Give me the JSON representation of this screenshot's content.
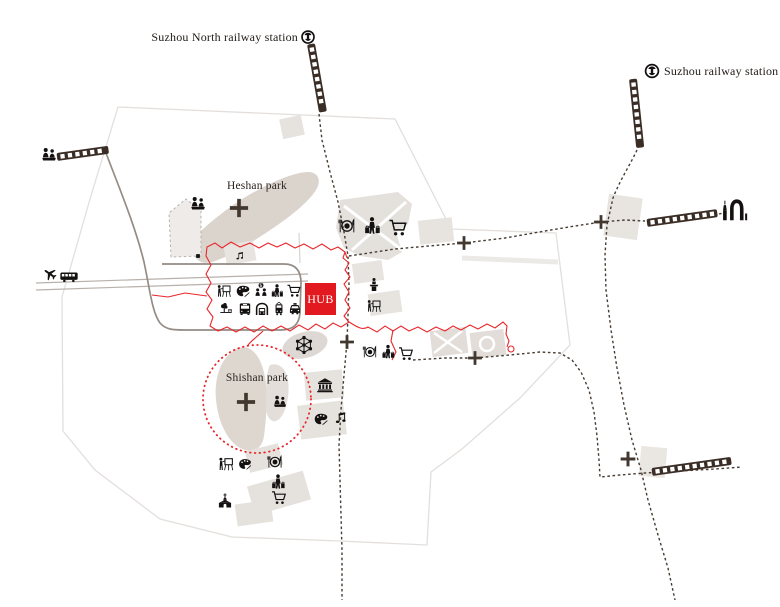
{
  "labels": {
    "station_north": "Suzhou North railway station",
    "station_main": "Suzhou railway station",
    "park_heshan": "Heshan park",
    "park_shishan": "Shishan park",
    "hub": "HUB"
  },
  "colors": {
    "accent_red": "#e2191f",
    "icon_black": "#141110",
    "dashed_line": "#463c33",
    "track_brown": "#3a2d25",
    "blob_light": "#e5e1dd"
  },
  "map": {
    "icons": [
      {
        "n": "people",
        "x": 49,
        "y": 155,
        "s": 18
      },
      {
        "n": "plane",
        "x": 50,
        "y": 274,
        "s": 15,
        "r": -55
      },
      {
        "n": "traincar",
        "x": 69,
        "y": 277,
        "s": 20
      },
      {
        "n": "people",
        "x": 198,
        "y": 204,
        "s": 18
      },
      {
        "n": "music",
        "x": 240,
        "y": 256,
        "s": 11
      },
      {
        "n": "marker-square",
        "x": 198,
        "y": 256,
        "s": 5
      },
      {
        "n": "dining",
        "x": 347,
        "y": 226,
        "s": 19
      },
      {
        "n": "shopper",
        "x": 372,
        "y": 226,
        "s": 21
      },
      {
        "n": "cart",
        "x": 398,
        "y": 228,
        "s": 21
      },
      {
        "n": "painter",
        "x": 224,
        "y": 291,
        "s": 16
      },
      {
        "n": "palette",
        "x": 243,
        "y": 291,
        "s": 16
      },
      {
        "n": "meeting",
        "x": 261,
        "y": 290,
        "s": 16
      },
      {
        "n": "shopper",
        "x": 277,
        "y": 291,
        "s": 16
      },
      {
        "n": "cart",
        "x": 294,
        "y": 291,
        "s": 16
      },
      {
        "n": "park",
        "x": 226,
        "y": 309,
        "s": 16
      },
      {
        "n": "bus",
        "x": 245,
        "y": 309,
        "s": 16
      },
      {
        "n": "metro",
        "x": 262,
        "y": 309,
        "s": 16
      },
      {
        "n": "tram",
        "x": 279,
        "y": 309,
        "s": 16
      },
      {
        "n": "taxi",
        "x": 295,
        "y": 309,
        "s": 16
      },
      {
        "n": "speaker",
        "x": 374,
        "y": 285,
        "s": 16
      },
      {
        "n": "painter",
        "x": 374,
        "y": 306,
        "s": 16
      },
      {
        "n": "network",
        "x": 304,
        "y": 345,
        "s": 24
      },
      {
        "n": "dining",
        "x": 370,
        "y": 352,
        "s": 16
      },
      {
        "n": "shopper",
        "x": 388,
        "y": 352,
        "s": 17
      },
      {
        "n": "cart",
        "x": 406,
        "y": 354,
        "s": 17
      },
      {
        "n": "museum",
        "x": 325,
        "y": 385,
        "s": 19
      },
      {
        "n": "people",
        "x": 280,
        "y": 402,
        "s": 16
      },
      {
        "n": "palette",
        "x": 321,
        "y": 419,
        "s": 16
      },
      {
        "n": "music",
        "x": 341,
        "y": 418,
        "s": 16
      },
      {
        "n": "painter",
        "x": 226,
        "y": 464,
        "s": 17
      },
      {
        "n": "palette",
        "x": 245,
        "y": 464,
        "s": 15
      },
      {
        "n": "dining",
        "x": 275,
        "y": 462,
        "s": 17
      },
      {
        "n": "shopper",
        "x": 278,
        "y": 482,
        "s": 18
      },
      {
        "n": "cart",
        "x": 279,
        "y": 498,
        "s": 17
      },
      {
        "n": "church",
        "x": 225,
        "y": 501,
        "s": 17
      },
      {
        "n": "raillogo",
        "x": 308,
        "y": 37,
        "s": 15
      },
      {
        "n": "raillogo",
        "x": 652,
        "y": 71,
        "s": 16
      },
      {
        "n": "skyline",
        "x": 735,
        "y": 209,
        "s": 27
      }
    ],
    "crosses": [
      {
        "x": 239,
        "y": 208,
        "s": 21
      },
      {
        "x": 246,
        "y": 402,
        "s": 21
      },
      {
        "x": 347,
        "y": 342,
        "s": 16
      },
      {
        "x": 464,
        "y": 243,
        "s": 16
      },
      {
        "x": 601,
        "y": 222,
        "s": 16
      },
      {
        "x": 475,
        "y": 358,
        "s": 16
      },
      {
        "x": 628,
        "y": 459,
        "s": 17
      }
    ],
    "tracks": [
      {
        "x": 57,
        "y": 157,
        "len": 52,
        "ang": -8
      },
      {
        "x": 311,
        "y": 44,
        "len": 69,
        "ang": 80
      },
      {
        "x": 633,
        "y": 79,
        "len": 69,
        "ang": 84
      },
      {
        "x": 647,
        "y": 223,
        "len": 71,
        "ang": -8
      },
      {
        "x": 652,
        "y": 472,
        "len": 80,
        "ang": -8
      }
    ]
  }
}
